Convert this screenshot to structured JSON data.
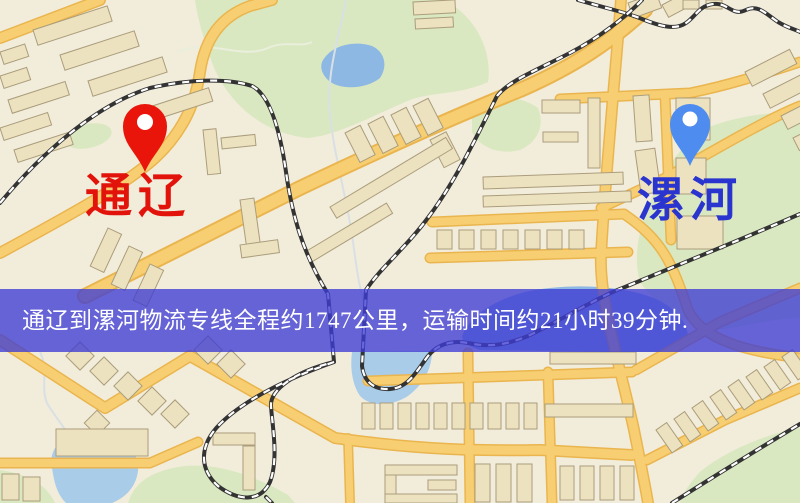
{
  "banner": {
    "text": "通辽到漯河物流专线全程约1747公里，运输时间约21小时39分钟."
  },
  "markers": {
    "origin": {
      "label": "通辽"
    },
    "destination": {
      "label": "漯河"
    }
  },
  "map_colors": {
    "origin_pin": "#e9150b",
    "origin_label": "#e2130b",
    "destination_pin": "#4e8cf0",
    "destination_label": "#2a35cf",
    "banner_bg": "rgba(62,60,212,0.78)",
    "banner_text": "#ffffff",
    "road_fill": "#f7cf72",
    "road_casing": "#eab54e",
    "park": "#d9e8c0",
    "water": "#8db8e4",
    "building": "#ece2c0",
    "background": "#f2ecdb",
    "railway": "#333333"
  }
}
